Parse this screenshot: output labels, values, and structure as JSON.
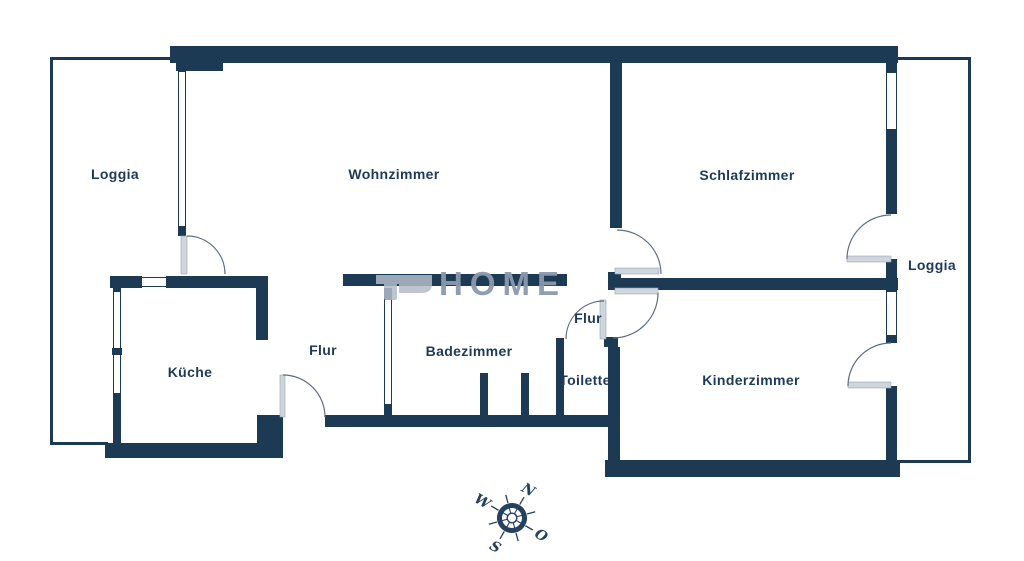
{
  "plan": {
    "rooms": [
      {
        "id": "loggia-left",
        "label": "Loggia"
      },
      {
        "id": "wohnzimmer",
        "label": "Wohnzimmer"
      },
      {
        "id": "schlafzimmer",
        "label": "Schlafzimmer"
      },
      {
        "id": "loggia-right",
        "label": "Loggia"
      },
      {
        "id": "kueche",
        "label": "Küche"
      },
      {
        "id": "flur",
        "label": "Flur"
      },
      {
        "id": "badezimmer",
        "label": "Badezimmer"
      },
      {
        "id": "flur-2",
        "label": "Flur"
      },
      {
        "id": "toilette",
        "label": "Toilette"
      },
      {
        "id": "kinderzimmer",
        "label": "Kinderzimmer"
      }
    ],
    "watermark": {
      "text": "HOME"
    },
    "compass": {
      "north": "N",
      "east": "O",
      "south": "S",
      "west": "W"
    },
    "colors": {
      "wall": "#1d3a55",
      "label": "#1e3a5a",
      "door_arc": "#5d6e82",
      "watermark": "#8b99ae",
      "door_leaf": "#cfd5dc"
    }
  }
}
